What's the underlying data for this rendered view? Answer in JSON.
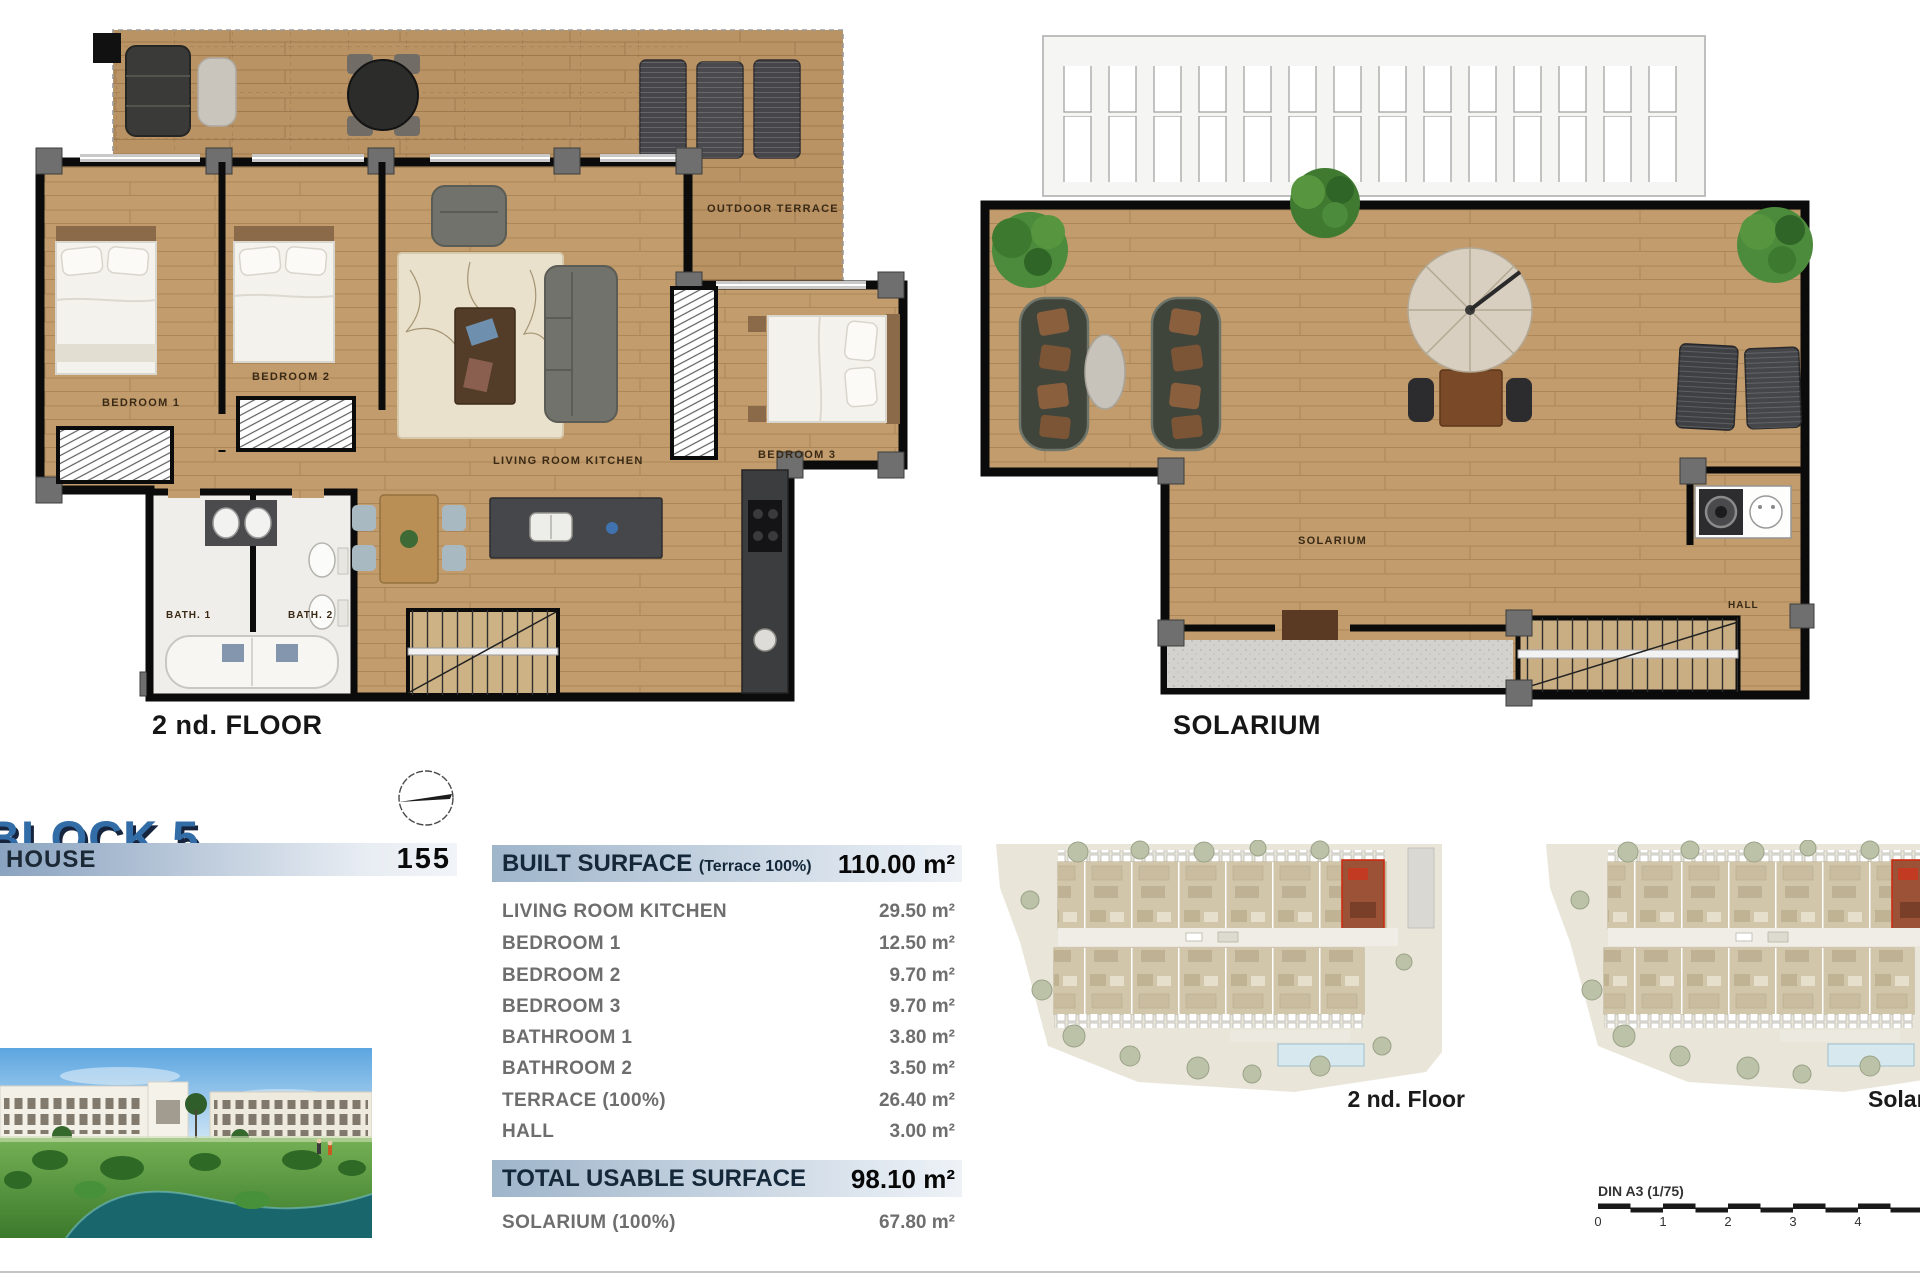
{
  "captions": {
    "plan1": "2 nd. FLOOR",
    "plan2": "SOLARIUM",
    "site1": "2 nd. Floor",
    "site2": "Solarium"
  },
  "floorplan": {
    "outdoor_terrace": "OUTDOOR TERRACE",
    "bedroom1": "BEDROOM 1",
    "bedroom2": "BEDROOM 2",
    "bedroom3": "BEDROOM 3",
    "living": "LIVING ROOM KITCHEN",
    "bath1": "BATH. 1",
    "bath2": "BATH. 2"
  },
  "solarium": {
    "room": "SOLARIUM",
    "hall": "HALL"
  },
  "title": {
    "block": "BLOCK 5",
    "house": "HOUSE",
    "number": "155"
  },
  "table": {
    "header_label": "BUILT SURFACE",
    "header_note": "(Terrace 100%)",
    "header_value": "110.00 m²",
    "rows": [
      {
        "label": "LIVING ROOM KITCHEN",
        "value": "29.50 m²"
      },
      {
        "label": "BEDROOM 1",
        "value": "12.50 m²"
      },
      {
        "label": "BEDROOM 2",
        "value": "9.70 m²"
      },
      {
        "label": "BEDROOM 3",
        "value": "9.70 m²"
      },
      {
        "label": "BATHROOM 1",
        "value": "3.80 m²"
      },
      {
        "label": "BATHROOM 2",
        "value": "3.50 m²"
      },
      {
        "label": "TERRACE (100%)",
        "value": "26.40 m²"
      },
      {
        "label": "HALL",
        "value": "3.00 m²"
      }
    ],
    "total_label": "TOTAL USABLE SURFACE",
    "total_value": "98.10 m²",
    "solarium_label": "SOLARIUM (100%)",
    "solarium_value": "67.80 m²"
  },
  "site": {
    "unit_highlight": "155"
  },
  "scale": {
    "label": "DIN A3 (1/75)",
    "ticks": [
      "0",
      "1",
      "2",
      "3",
      "4"
    ]
  },
  "colors": {
    "accent_blue": "#336da8",
    "navy": "#16243e",
    "bar_start": "#8aa3c0",
    "bar_end": "#edf1f6",
    "wood": "#c29c6d",
    "wall": "#0b0b0b",
    "highlight_red": "#cc2b12"
  }
}
